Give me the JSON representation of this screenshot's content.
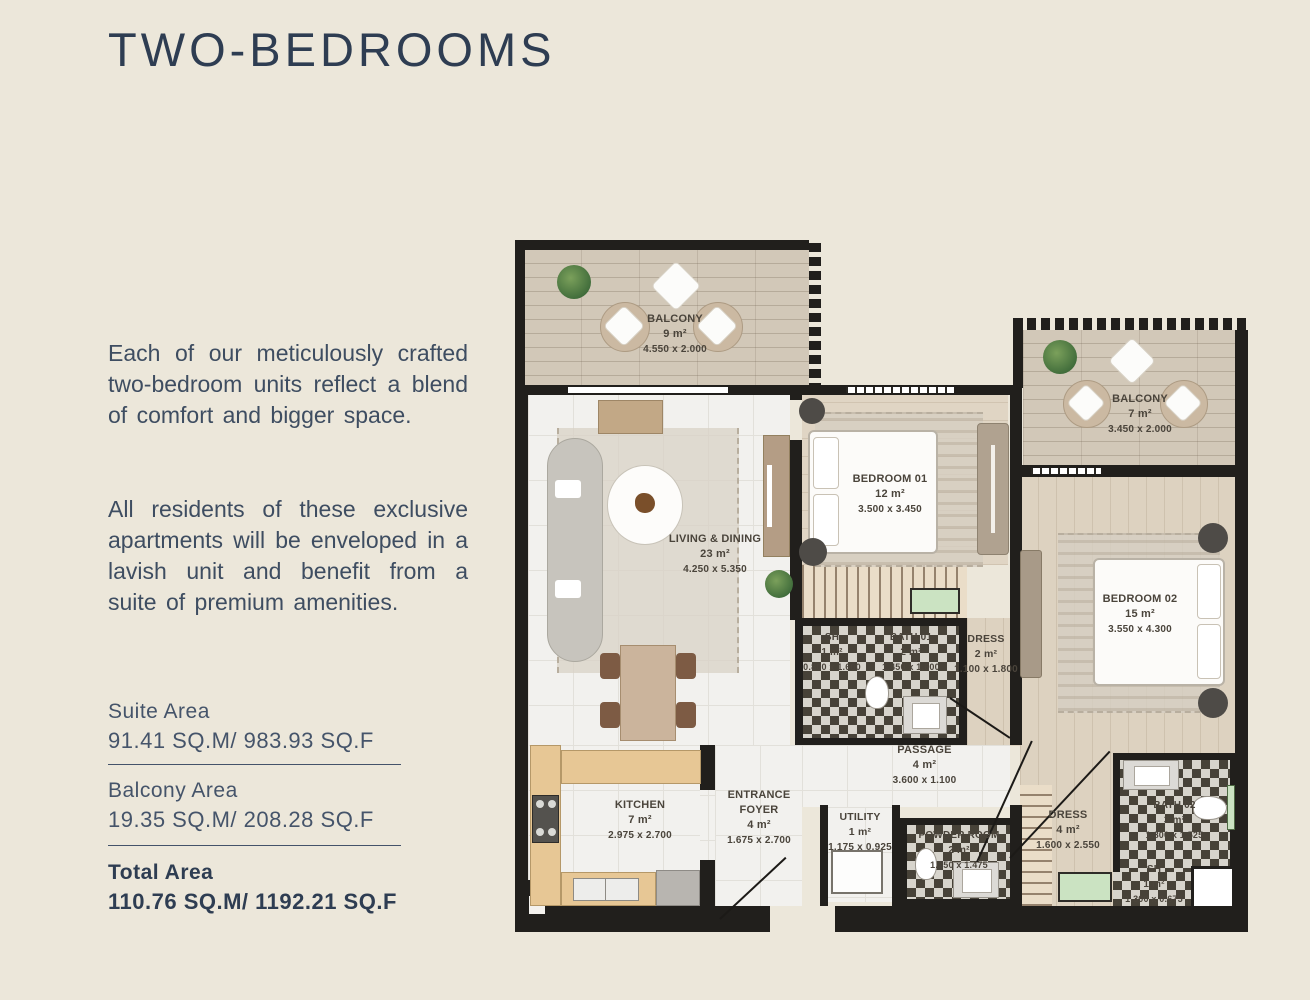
{
  "page": {
    "title": "TWO-BEDROOMS"
  },
  "description": {
    "para1": "Each of our meticulously crafted two-bedroom units reflect a blend of comfort and bigger space.",
    "para2": "All residents of these exclusive apartments will be enveloped in a lavish unit and benefit from a suite of premium amenities."
  },
  "areas": {
    "suite": {
      "label": "Suite Area",
      "value": "91.41 SQ.M/ 983.93 SQ.F"
    },
    "balcony": {
      "label": "Balcony Area",
      "value": "19.35 SQ.M/ 208.28 SQ.F"
    },
    "total": {
      "label": "Total Area",
      "value": "110.76 SQ.M/ 1192.21 SQ.F"
    }
  },
  "floorplan": {
    "rooms": {
      "balcony1": {
        "name": "BALCONY",
        "area": "9 m²",
        "dims": "4.550 x 2.000"
      },
      "living": {
        "name": "LIVING & DINING",
        "area": "23 m²",
        "dims": "4.250 x 5.350"
      },
      "bedroom1": {
        "name": "BEDROOM 01",
        "area": "12 m²",
        "dims": "3.500 x 3.450"
      },
      "balcony2": {
        "name": "BALCONY",
        "area": "7 m²",
        "dims": "3.450 x 2.000"
      },
      "bedroom2": {
        "name": "BEDROOM 02",
        "area": "15 m²",
        "dims": "3.550 x 4.300"
      },
      "sh1": {
        "name": "SH",
        "area": "1 m²",
        "dims": "0.800 x 1.600"
      },
      "bath1": {
        "name": "BATH 01",
        "area": "2 m²",
        "dims": "1.450 x 1.600"
      },
      "dress1": {
        "name": "DRESS",
        "area": "2 m²",
        "dims": "1.100 x 1.800"
      },
      "passage": {
        "name": "PASSAGE",
        "area": "4 m²",
        "dims": "3.600 x 1.100"
      },
      "kitchen": {
        "name": "KITCHEN",
        "area": "7 m²",
        "dims": "2.975 x 2.700"
      },
      "foyer": {
        "name": "ENTRANCE FOYER",
        "area": "4 m²",
        "dims": "1.675 x 2.700"
      },
      "utility": {
        "name": "UTILITY",
        "area": "1 m²",
        "dims": "1.175 x 0.925"
      },
      "powder": {
        "name": "POWDER ROOM",
        "area": "2 m²",
        "dims": "1.750 x 1.475"
      },
      "dress2": {
        "name": "DRESS",
        "area": "4 m²",
        "dims": "1.600 x 2.550"
      },
      "bath2": {
        "name": "BATH 02",
        "area": "3 m²",
        "dims": "1.800 x 1.525"
      },
      "sh2": {
        "name": "SH",
        "area": "1 m²",
        "dims": "1.300 x 0.675"
      }
    }
  },
  "colors": {
    "background": "#ECE7DA",
    "accent_navy": "#2E3D52",
    "body_text": "#3E4D61",
    "plan_wall": "#211F1C"
  }
}
